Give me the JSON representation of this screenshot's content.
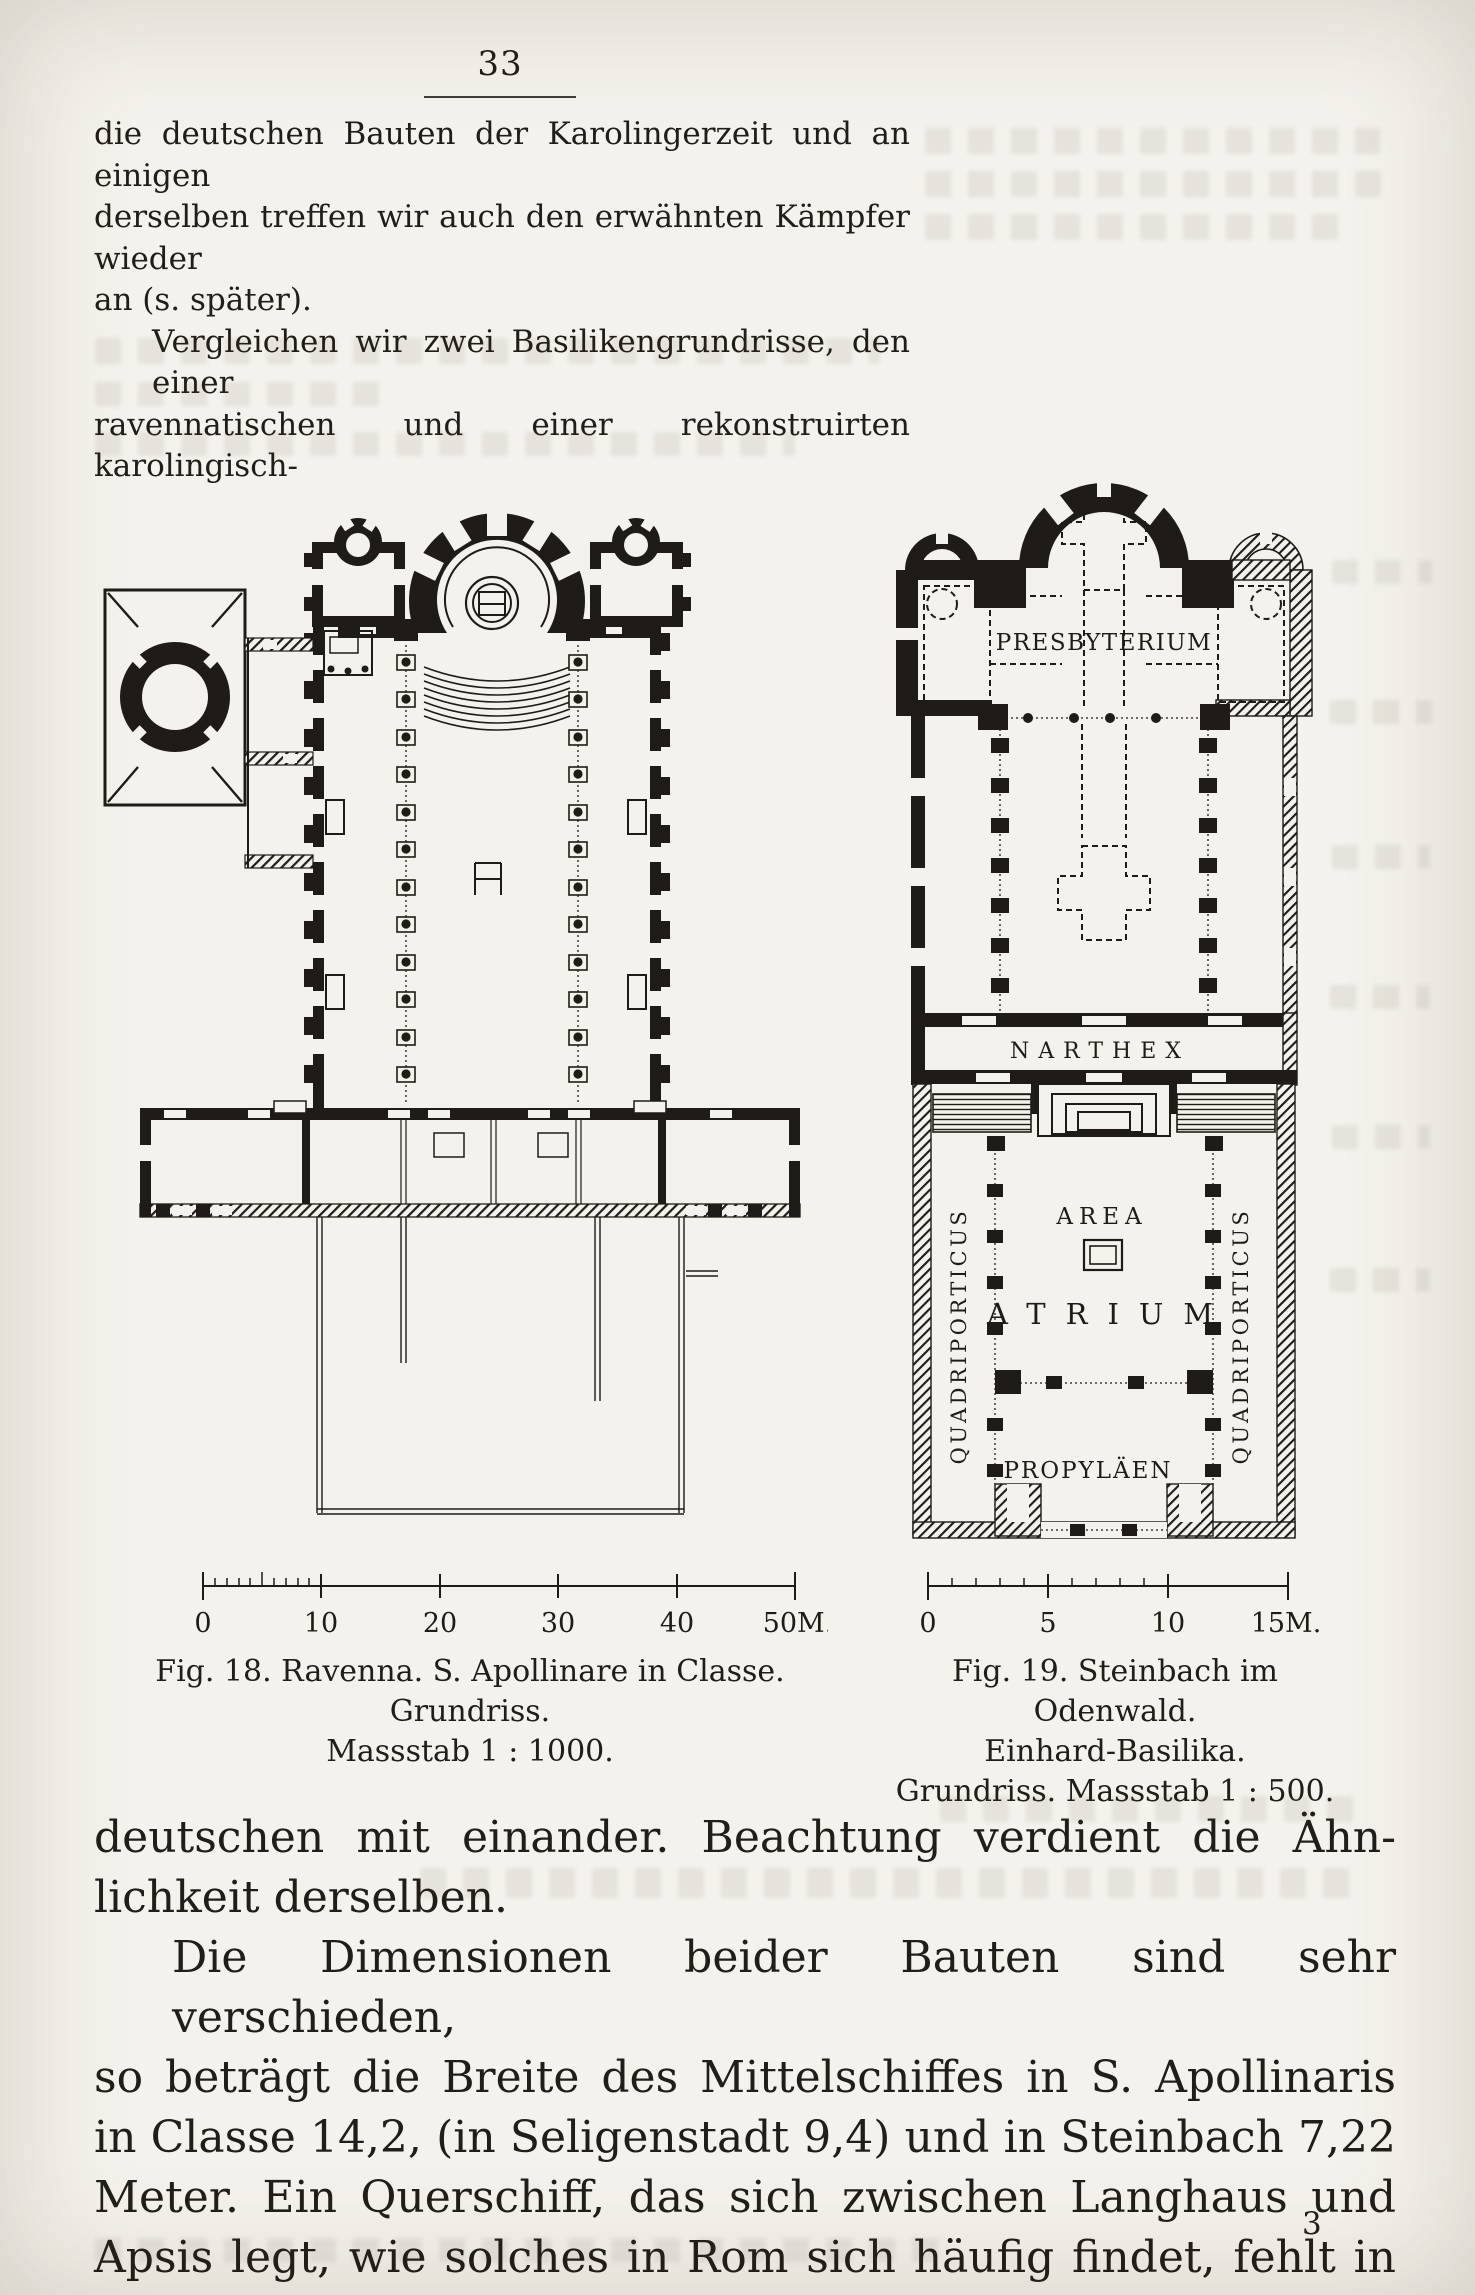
{
  "page": {
    "number": "33",
    "signature": "3"
  },
  "paragraphs": {
    "para1": [
      "die deutschen Bauten der Karolingerzeit und an einigen",
      "derselben treffen wir auch den erwähnten Kämpfer wieder",
      "an (s. später)."
    ],
    "para2": [
      "Vergleichen wir zwei Basilikengrundrisse, den einer",
      "ravennatischen und einer rekonstruirten karolingisch-"
    ],
    "para3": [
      "deutschen mit einander.  Beachtung verdient die Ähn-",
      "lichkeit derselben."
    ],
    "para4": [
      "Die Dimensionen beider Bauten sind sehr verschieden,",
      "so beträgt die Breite des Mittelschiffes in S. Apollinaris",
      "in Classe 14,2, (in Seligenstadt 9,4) und in Steinbach 7,22",
      "Meter.  Ein Querschiff, das sich zwischen Langhaus und",
      "Apsis legt, wie solches in Rom sich häufig findet, fehlt in"
    ]
  },
  "figures": {
    "fig18": {
      "caption": [
        "Fig. 18.  Ravenna.  S. Apollinare in Classe.",
        "Grundriss.",
        "Massstab 1 : 1000."
      ],
      "scale": [
        "0",
        "10",
        "20",
        "30",
        "40",
        "50M."
      ]
    },
    "fig19": {
      "caption": [
        "Fig. 19. Steinbach im Odenwald.",
        "Einhard-Basilika.",
        "Grundriss.  Massstab 1 : 500."
      ],
      "scale": [
        "0",
        "5",
        "10",
        "15M."
      ],
      "labels": {
        "presbyterium": "PRESBYTERIUM",
        "narthex": "NARTHEX",
        "area": "AREA",
        "atrium": "ATRIUM",
        "quadriporticus_left": "QUADRIPORTICUS",
        "quadriporticus_right": "QUADRIPORTICUS",
        "propylaeen": "PROPYLÄEN"
      }
    }
  },
  "colors": {
    "paper": "#f4f2ec",
    "ink": "#1f1b16"
  }
}
